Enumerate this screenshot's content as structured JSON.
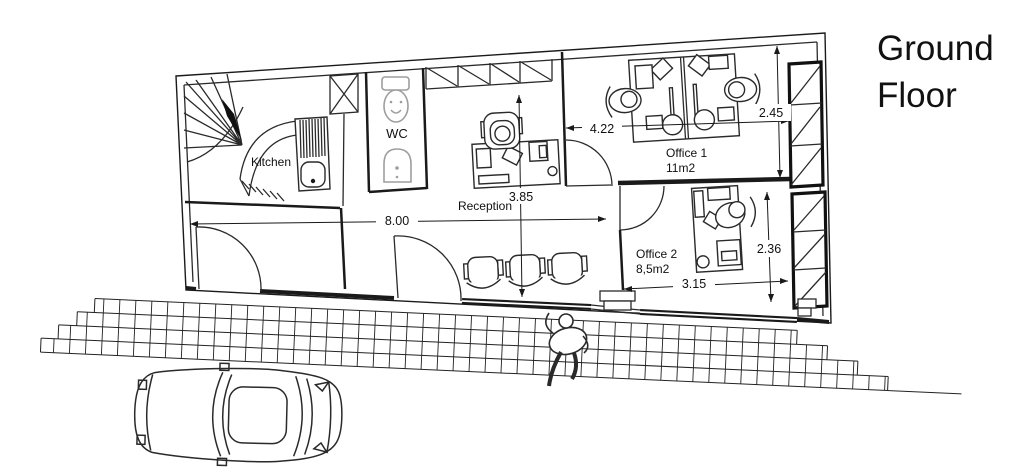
{
  "title": {
    "line1": "Ground",
    "line2": "Floor"
  },
  "rooms": {
    "kitchen": "Kitchen",
    "wc": "WC",
    "reception": "Reception",
    "office1": {
      "name": "Office 1",
      "area": "11m2"
    },
    "office2": {
      "name": "Office 2",
      "area": "8,5m2"
    }
  },
  "dimensions": {
    "hall_width": "8.00",
    "reception_depth": "3.85",
    "office1_width": "4.22",
    "office1_depth": "2.45",
    "office2_width": "3.15",
    "office2_depth": "2.36"
  },
  "colors": {
    "line": "#1a1a1a",
    "fixture": "#9e9e9e",
    "background": "#ffffff"
  }
}
